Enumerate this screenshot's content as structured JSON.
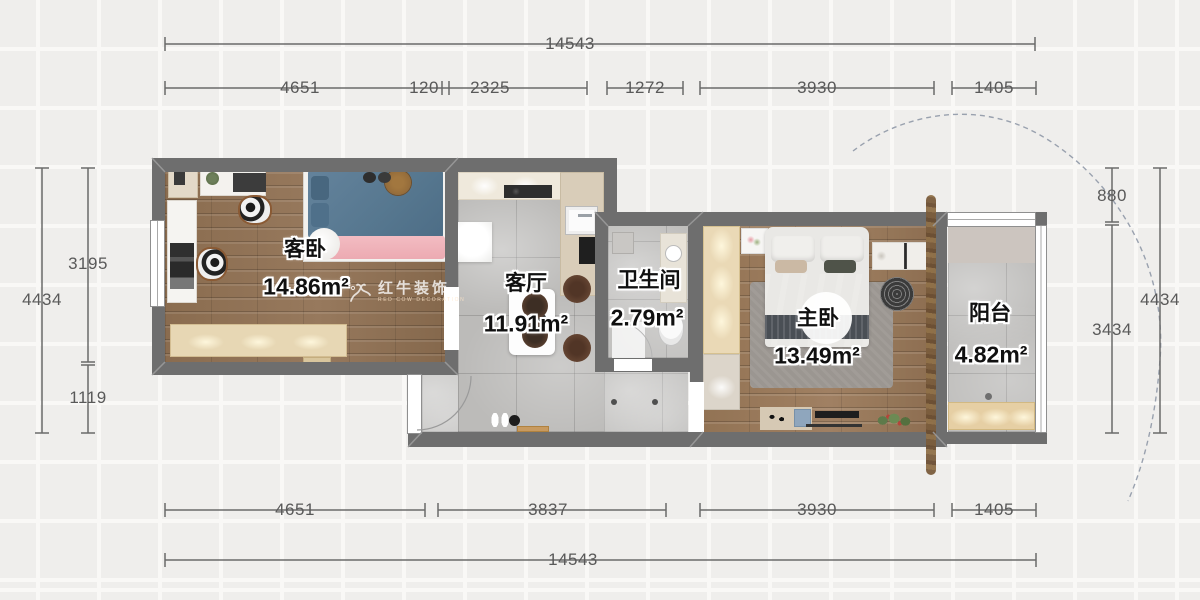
{
  "watermark": {
    "brand": "红牛装饰",
    "tagline": "RED COW DECORATION"
  },
  "rooms": {
    "guest_bedroom": {
      "name": "客卧",
      "area": "14.86m²"
    },
    "living_room": {
      "name": "客厅",
      "area": "11.91m²"
    },
    "bathroom": {
      "name": "卫生间",
      "area": "2.79m²"
    },
    "master_bedroom": {
      "name": "主卧",
      "area": "13.49m²"
    },
    "balcony": {
      "name": "阳台",
      "area": "4.82m²"
    }
  },
  "dimensions": {
    "top_total": "14543",
    "top_segments": [
      "4651",
      "120",
      "2325",
      "1272",
      "3930",
      "1405"
    ],
    "bottom_segments": [
      "4651",
      "3837",
      "3930",
      "1405"
    ],
    "bottom_total": "14543",
    "left": {
      "outer_total": "4434",
      "segments": [
        "3195",
        "1119"
      ]
    },
    "right": {
      "segments": [
        "880",
        "3434"
      ],
      "outer_total": "4434"
    }
  },
  "colors": {
    "wall": "#6e6e6e",
    "wood_floor": "#8d7054",
    "tile_floor": "#bcbbb9",
    "wardrobe": "#e9d8b5",
    "dimension_text": "#595959"
  }
}
